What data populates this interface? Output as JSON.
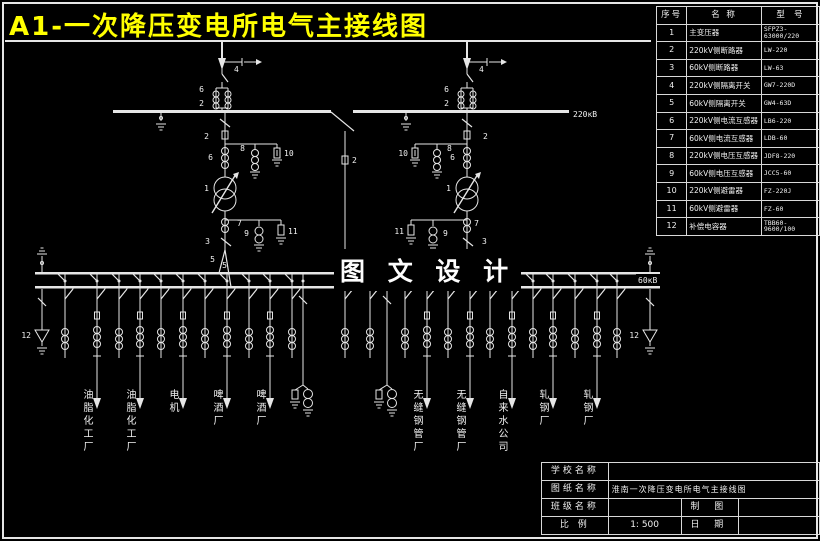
{
  "page": {
    "title": "A1-一次降压变电所电气主接线图"
  },
  "diagram": {
    "hv_bus_label": "220кВ",
    "lv_bus_label": "60кВ",
    "center_text": "图 文 设 计"
  },
  "component_table": {
    "headers": [
      "序号",
      "名 称",
      "型 号"
    ],
    "rows": [
      [
        "1",
        "主变压器",
        "SFPZ3-63000/220"
      ],
      [
        "2",
        "220kV侧断路器",
        "LW-220"
      ],
      [
        "3",
        "60kV侧断路器",
        "LW-63"
      ],
      [
        "4",
        "220kV侧隔离开关",
        "GW7-220D"
      ],
      [
        "5",
        "60kV侧隔离开关",
        "GW4-63D"
      ],
      [
        "6",
        "220kV侧电流互感器",
        "LB6-220"
      ],
      [
        "7",
        "60kV侧电流互感器",
        "LDB-60"
      ],
      [
        "8",
        "220kV侧电压互感器",
        "JDF8-220"
      ],
      [
        "9",
        "60kV侧电压互感器",
        "JCC5-60"
      ],
      [
        "10",
        "220kV侧避雷器",
        "FZ-220J"
      ],
      [
        "11",
        "60kV侧避雷器",
        "FZ-60"
      ],
      [
        "12",
        "补偿电容器",
        "TBB60-9600/100"
      ]
    ]
  },
  "feeders": {
    "labels": [
      "油脂化工厂",
      "油脂化工厂",
      "电机",
      "啤酒厂",
      "啤酒厂",
      "无缝钢管厂",
      "无缝钢管厂",
      "自来水公司",
      "轧钢厂",
      "轧钢厂"
    ]
  },
  "title_block": {
    "school_label": "学校名称",
    "school_value": "",
    "drawing_label": "图纸名称",
    "drawing_value": "淮南一次降压变电所电气主接线图",
    "class_label": "班级名称",
    "class_value": "",
    "maker_label": "制 图",
    "maker_value": "",
    "scale_label": "比 例",
    "scale_value": "1: 500",
    "date_label": "日 期",
    "date_value": ""
  }
}
